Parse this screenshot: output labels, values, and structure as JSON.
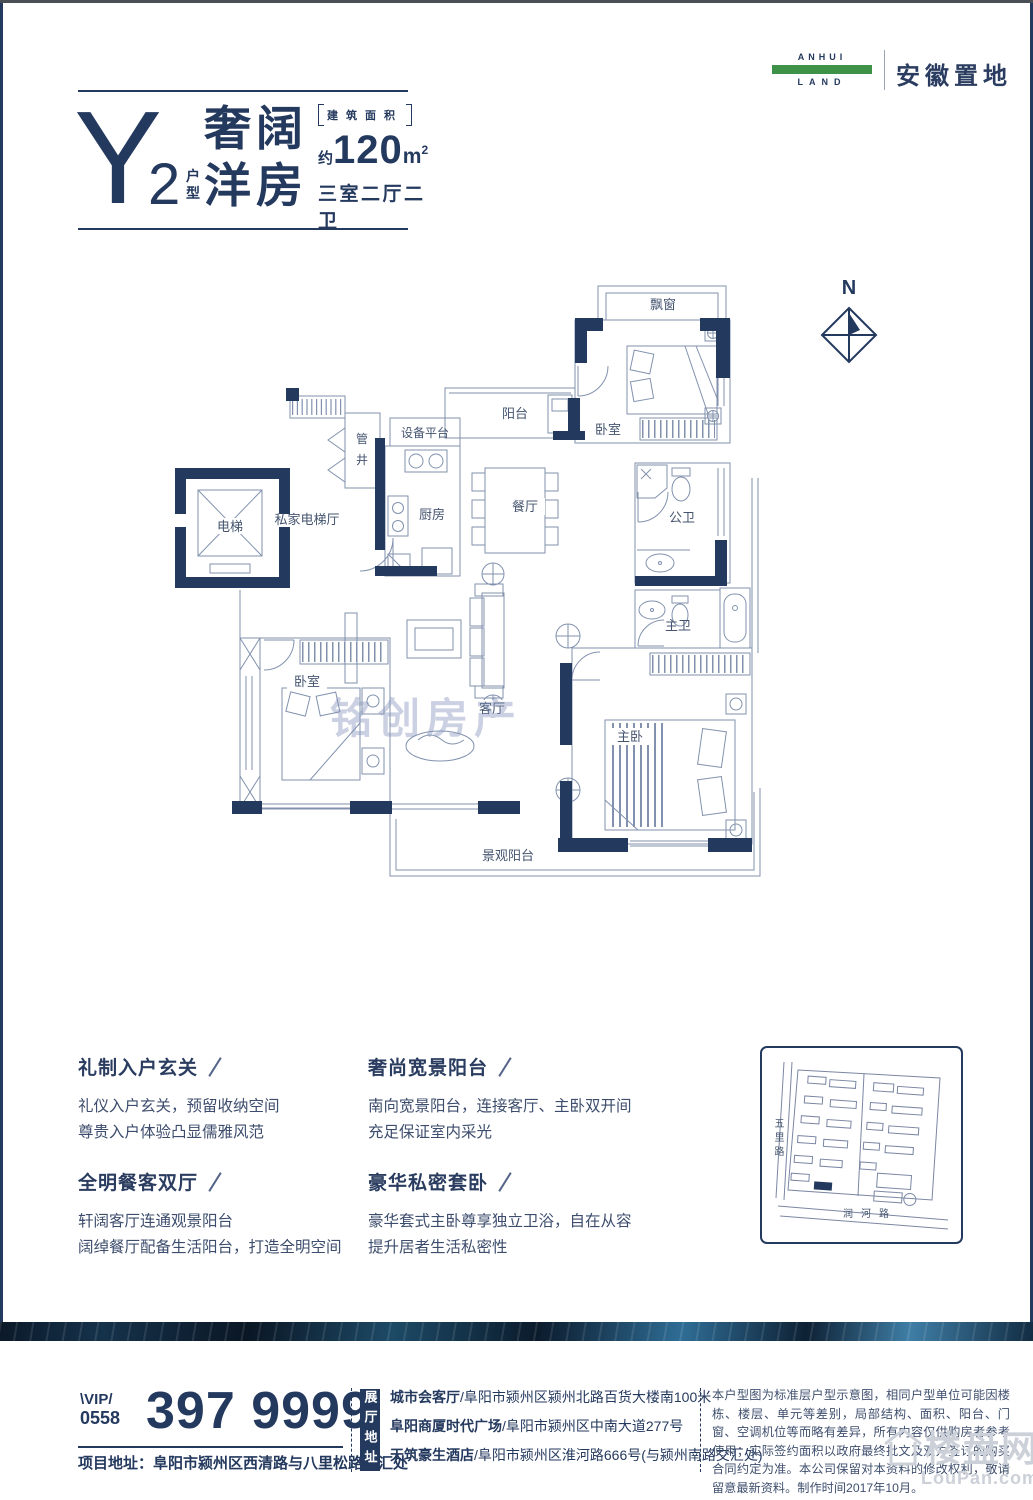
{
  "colors": {
    "navy": "#24395e",
    "green": "#3e9247",
    "plan_line": "#8292ae",
    "body_text": "#3d4d6d"
  },
  "brand": {
    "anhui": "ANHUI",
    "land": "LAND",
    "name": "安徽置地"
  },
  "title": {
    "letter": "Y",
    "number": "2",
    "unit_char_1": "户",
    "unit_char_2": "型",
    "headline_line1": "奢阔",
    "headline_line2": "洋房",
    "area_bracket": "建筑面积",
    "approx": "约",
    "area_value": "120",
    "area_unit": "m",
    "area_sup": "2",
    "layout": "三室二厅二卫"
  },
  "plan": {
    "north": "N",
    "watermark": "铭创房产",
    "rooms": {
      "bay_window": "飘窗",
      "balcony": "阳台",
      "equipment": "设备平台",
      "shaft_1": "管",
      "shaft_2": "井",
      "bedroom_top": "卧室",
      "elevator": "电梯",
      "elevator_hall": "私家电梯厅",
      "kitchen": "厨房",
      "dining": "餐厅",
      "bath_public": "公卫",
      "bath_master": "主卫",
      "bedroom_left": "卧室",
      "living": "客厅",
      "master_bedroom": "主卧",
      "view_balcony": "景观阳台"
    }
  },
  "features": [
    {
      "title": "礼制入户玄关",
      "lines": [
        "礼仪入户玄关，预留收纳空间",
        "尊贵入户体验凸显儒雅风范"
      ]
    },
    {
      "title": "奢尚宽景阳台",
      "lines": [
        "南向宽景阳台，连接客厅、主卧双开间",
        "充足保证室内采光"
      ]
    },
    {
      "title": "全明餐客双厅",
      "lines": [
        "轩阔客厅连通观景阳台",
        "阔绰餐厅配备生活阳台，打造全明空间"
      ]
    },
    {
      "title": "豪华私密套卧",
      "lines": [
        "豪华套式主卧尊享独立卫浴，自在从容",
        "提升居者生活私密性"
      ]
    }
  ],
  "site_map": {
    "road_left": "五里路",
    "road_bottom": "润河路"
  },
  "contact": {
    "vip_label": "\\VIP/",
    "vip_code": "0558",
    "phone": "397 9999",
    "project_address": "项目地址：阜阳市颍州区西清路与八里松路交汇处",
    "showroom_label": "展厅地址",
    "showrooms": [
      {
        "name": "城市会客厅",
        "address": "/阜阳市颍州区颍州北路百货大楼南100米"
      },
      {
        "name": "阜阳商厦时代广场",
        "address": "/阜阳市颍州区中南大道277号"
      },
      {
        "name": "天筑豪生酒店",
        "address": "/阜阳市颍州区淮河路666号(与颍州南路交汇处)"
      }
    ]
  },
  "disclaimer": "本户型图为标准层户型示意图，相同户型单位可能因楼栋、楼层、单元等差别，局部结构、面积、阳台、门窗、空调机位等而略有差异，所有内容仅供购房者参考使用；实际签约面积以政府最终批文及双方签订的购买合同约定为准。本公司保留对本资料的修改权利，敬请留意最新资料。制作时间2017年10月。",
  "footer_watermark": {
    "name": "楼盘网",
    "domain": "LouPan.com"
  }
}
